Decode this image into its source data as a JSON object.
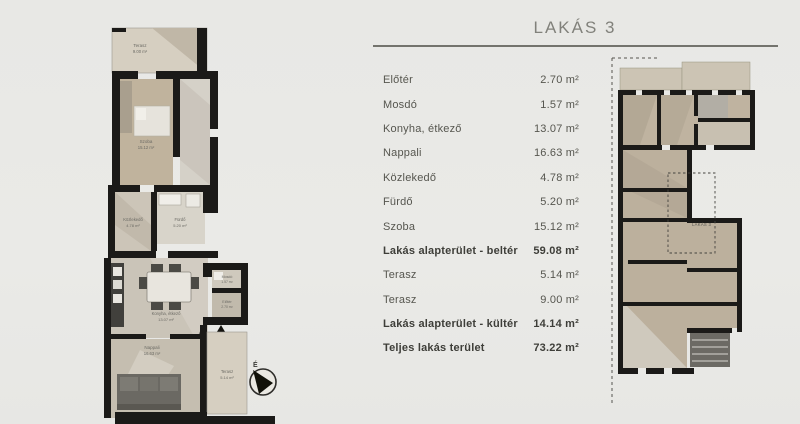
{
  "page": {
    "title": "LAKÁS 3"
  },
  "area_table": {
    "rows": [
      {
        "label": "Előtér",
        "value": "2.70 m²",
        "bold": false
      },
      {
        "label": "Mosdó",
        "value": "1.57 m²",
        "bold": false
      },
      {
        "label": "Konyha, étkező",
        "value": "13.07 m²",
        "bold": false
      },
      {
        "label": "Nappali",
        "value": "16.63 m²",
        "bold": false
      },
      {
        "label": "Közlekedő",
        "value": "4.78 m²",
        "bold": false
      },
      {
        "label": "Fürdő",
        "value": "5.20 m²",
        "bold": false
      },
      {
        "label": "Szoba",
        "value": "15.12 m²",
        "bold": false
      },
      {
        "label": "Lakás alapterület - beltér",
        "value": "59.08 m²",
        "bold": true
      },
      {
        "label": "Terasz",
        "value": "5.14 m²",
        "bold": false
      },
      {
        "label": "Terasz",
        "value": "9.00 m²",
        "bold": false
      },
      {
        "label": "Lakás alapterület - kültér",
        "value": "14.14 m²",
        "bold": true
      },
      {
        "label": "Teljes lakás terület",
        "value": "73.22 m²",
        "bold": true
      }
    ]
  },
  "floor_plan": {
    "rooms": {
      "terasz_top": {
        "name": "Terasz",
        "area": "9.00 m²"
      },
      "szoba": {
        "name": "Szoba",
        "area": "15.12 m²"
      },
      "kozlekedo": {
        "name": "Közlekedő",
        "area": "4.78 m²"
      },
      "furdo": {
        "name": "Fürdő",
        "area": "5.20 m²"
      },
      "konyha": {
        "name": "Konyha, étkező",
        "area": "13.07 m²"
      },
      "mosdo": {
        "name": "Mosdó",
        "area": "1.57 m²"
      },
      "eloter": {
        "name": "Előtér",
        "area": "2.70 m²"
      },
      "nappali": {
        "name": "Nappali",
        "area": "16.63 m²"
      },
      "terasz_bottom": {
        "name": "Terasz",
        "area": "5.14 m²"
      }
    },
    "north_label": "É"
  },
  "overview_plan": {
    "apartment_label": "LAKÁS 3"
  },
  "colors": {
    "wall": "#1b1a18",
    "room_tan": "#c0b39d",
    "room_light": "#d5d1c8",
    "terrace": "#d6cfc1",
    "furniture_dark": "#6b6963",
    "text": "#56564f",
    "text_bold": "#3e3e39",
    "title": "#81817b",
    "rule": "#73736d"
  }
}
